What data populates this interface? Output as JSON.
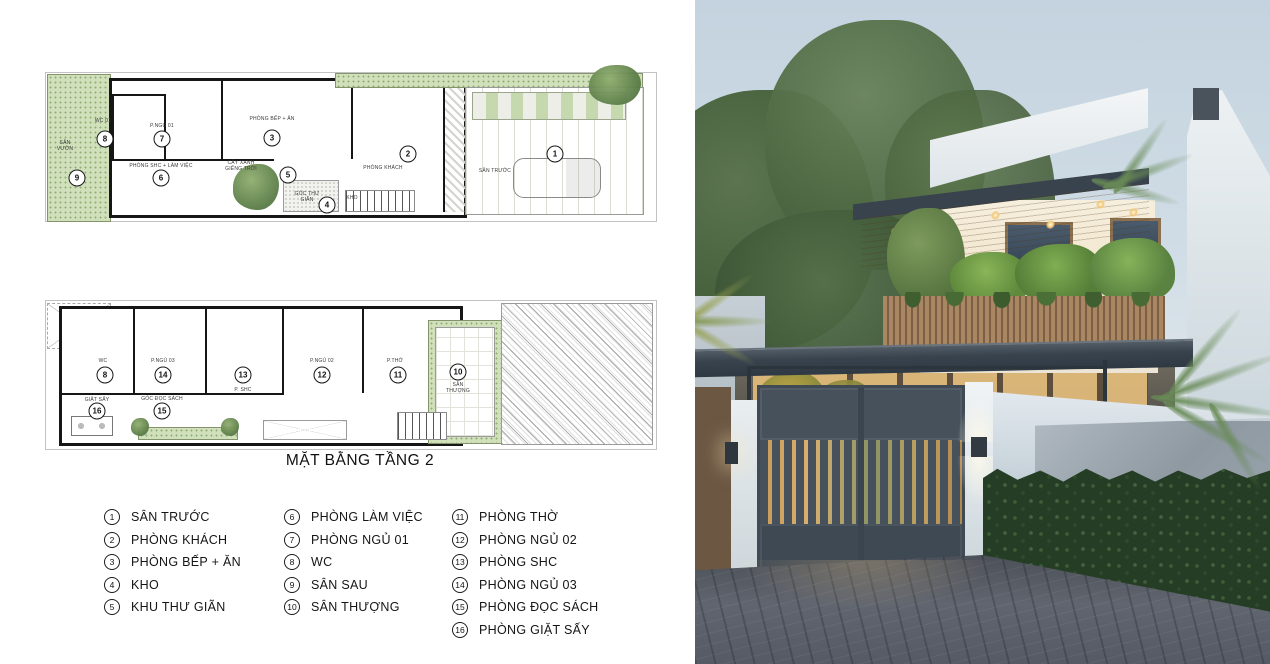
{
  "title": "MẶT BẰNG TẦNG 2",
  "plan1": {
    "circles": [
      "9",
      "8",
      "7",
      "6",
      "3",
      "5",
      "4",
      "2",
      "1"
    ],
    "labels": [
      "SÂN VƯỜN",
      "WC 01",
      "P.NGỦ 01",
      "PHÒNG SHC + LÀM VIỆC",
      "PHÒNG BẾP + ĂN",
      "CÂY XANH GIẾNG TRỜI",
      "GÓC THƯ GIÃN",
      "KHO",
      "PHÒNG KHÁCH",
      "SÂN TRƯỚC"
    ]
  },
  "plan2": {
    "circles": [
      "8",
      "14",
      "13",
      "12",
      "11",
      "10",
      "16",
      "15"
    ],
    "labels": [
      "WC",
      "P.NGỦ 03",
      "P. SHC",
      "P.NGỦ 02",
      "P.THỜ",
      "SÂN THƯỢNG",
      "GÓC ĐỌC SÁCH",
      "GIẶT SẤY"
    ]
  },
  "legend": {
    "columns": [
      {
        "items": [
          {
            "num": "1",
            "label": "SÂN TRƯỚC"
          },
          {
            "num": "2",
            "label": "PHÒNG KHÁCH"
          },
          {
            "num": "3",
            "label": "PHÒNG BẾP + ĂN"
          },
          {
            "num": "4",
            "label": "KHO"
          },
          {
            "num": "5",
            "label": "KHU THƯ GIÃN"
          }
        ]
      },
      {
        "items": [
          {
            "num": "6",
            "label": "PHÒNG LÀM VIỆC"
          },
          {
            "num": "7",
            "label": "PHÒNG NGỦ 01"
          },
          {
            "num": "8",
            "label": "WC"
          },
          {
            "num": "9",
            "label": "SÂN SAU"
          },
          {
            "num": "10",
            "label": "SÂN THƯỢNG"
          }
        ]
      },
      {
        "items": [
          {
            "num": "11",
            "label": "PHÒNG THỜ"
          },
          {
            "num": "12",
            "label": "PHÒNG NGỦ 02"
          },
          {
            "num": "13",
            "label": "PHÒNG SHC"
          },
          {
            "num": "14",
            "label": "PHÒNG NGỦ 03"
          },
          {
            "num": "15",
            "label": "PHÒNG ĐỌC SÁCH"
          },
          {
            "num": "16",
            "label": "PHÒNG GIẶT SẤY"
          }
        ]
      }
    ]
  },
  "colors": {
    "sky": "#c4d3df",
    "roof_canopy": "#39434d",
    "wood_soffit": "#c7975f",
    "balcony_wood": "#9c7c5a",
    "gate": "#46515c",
    "hedge": "#2c452b",
    "pavement": "#565b64",
    "plan_green": "#cfe0bb",
    "warm_light": "#e6be7c"
  }
}
